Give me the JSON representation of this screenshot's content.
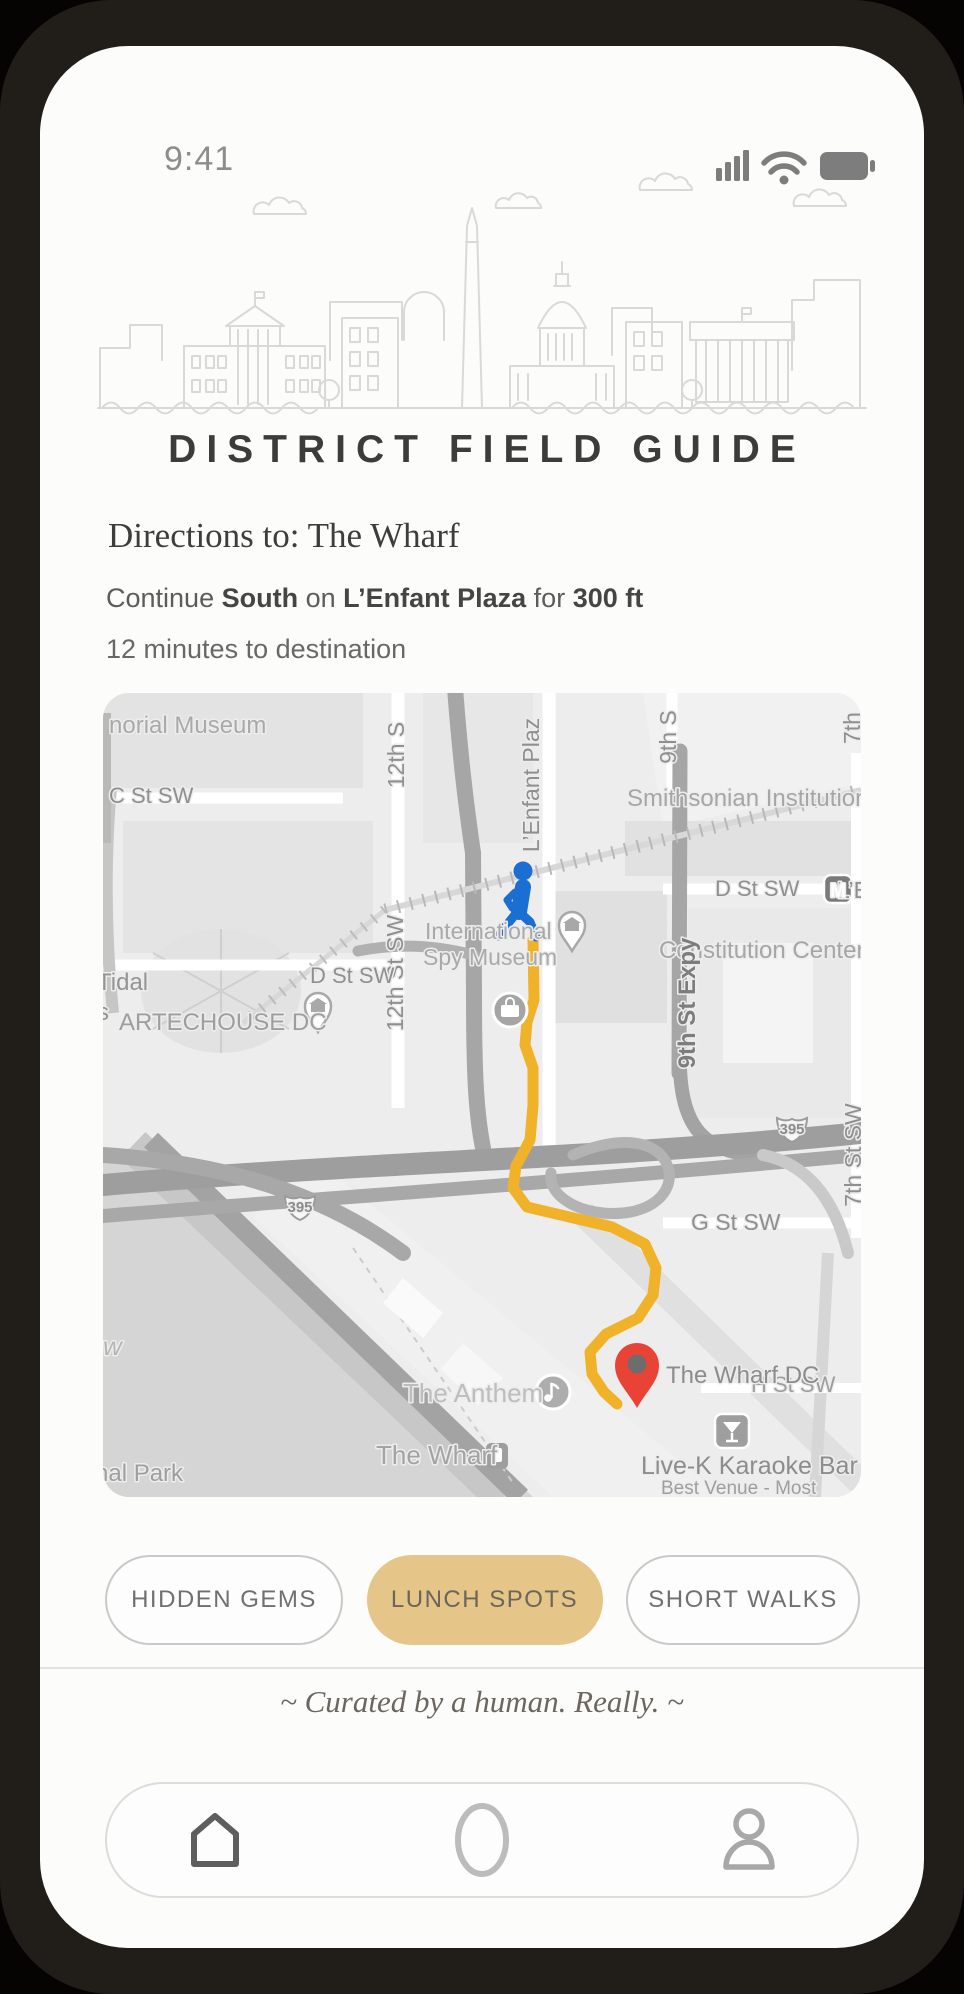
{
  "status_bar": {
    "time": "9:41",
    "icons": [
      "signal-bars",
      "wifi",
      "battery"
    ]
  },
  "header": {
    "title": "DISTRICT FIELD GUIDE",
    "skyline": "washington-dc-skyline-illustration"
  },
  "directions": {
    "heading": "Directions to: The Wharf",
    "step_segments": [
      {
        "text": "Continue ",
        "bold": false
      },
      {
        "text": "South",
        "bold": true
      },
      {
        "text": " on ",
        "bold": false
      },
      {
        "text": "L’Enfant Plaza",
        "bold": true
      },
      {
        "text": " for ",
        "bold": false
      },
      {
        "text": "300 ft",
        "bold": true
      }
    ],
    "eta": "12 minutes to destination"
  },
  "map": {
    "destination": "The Wharf DC",
    "route_color": "#F0B228",
    "walker_color": "#1C6FD2",
    "pin_color": "#E94335",
    "route_points": "430,247 431,307 424,329 422,352 430,375 430,412 427,447 413,473 410,495 424,514 462,523 509,534 542,551 553,575 550,602 535,625 503,641 487,659 489,681 501,699 514,711",
    "labels": [
      {
        "t": "norial Museum",
        "x": 6,
        "y": 40,
        "s": 24,
        "c": "#a9a9a9"
      },
      {
        "t": "C St SW",
        "x": 6,
        "y": 110,
        "s": 22,
        "c": "#8f8f8f"
      },
      {
        "t": "Tidal",
        "x": -6,
        "y": 297,
        "s": 24,
        "c": "#949494"
      },
      {
        "t": "s",
        "x": -6,
        "y": 327,
        "s": 24,
        "c": "#949494"
      },
      {
        "t": "12th S",
        "x": 301,
        "y": 62,
        "s": 23,
        "c": "#8f8f8f",
        "r": -90,
        "a": "middle"
      },
      {
        "t": "12th St SW",
        "x": 300,
        "y": 280,
        "s": 23,
        "c": "#8f8f8f",
        "r": -90,
        "a": "middle"
      },
      {
        "t": "D St SW",
        "x": 207,
        "y": 290,
        "s": 22,
        "c": "#8f8f8f"
      },
      {
        "t": "ARTECHOUSE DC",
        "x": 16,
        "y": 337,
        "s": 24,
        "c": "#9e9e9e"
      },
      {
        "t": "International",
        "x": 322,
        "y": 246,
        "s": 23,
        "c": "#a9a9a9"
      },
      {
        "t": "Spy Museum",
        "x": 320,
        "y": 272,
        "s": 23,
        "c": "#a9a9a9"
      },
      {
        "t": "L’Enfant Plaz",
        "x": 436,
        "y": 92,
        "s": 23,
        "c": "#8f8f8f",
        "r": -90,
        "a": "middle"
      },
      {
        "t": "9th S",
        "x": 573,
        "y": 44,
        "s": 23,
        "c": "#8f8f8f",
        "r": -90,
        "a": "middle"
      },
      {
        "t": "Smithsonian Institution",
        "x": 524,
        "y": 113,
        "s": 24,
        "c": "#a6a6a6"
      },
      {
        "t": "L’Enfant Pl",
        "x": 734,
        "y": 205,
        "s": 23,
        "c": "#8f8f8f"
      },
      {
        "t": "D St SW",
        "x": 612,
        "y": 203,
        "s": 22,
        "c": "#8f8f8f"
      },
      {
        "t": "M",
        "x": 735,
        "y": 204,
        "s": 19,
        "c": "#ffffff",
        "w": 700,
        "a": "middle"
      },
      {
        "t": "Constitution Center",
        "x": 556,
        "y": 265,
        "s": 24,
        "c": "#a6a6a6"
      },
      {
        "t": "9th St Expy",
        "x": 592,
        "y": 310,
        "s": 24,
        "c": "#7d7d7d",
        "r": -90,
        "a": "middle",
        "w": 600
      },
      {
        "t": "7th",
        "x": 757,
        "y": 35,
        "s": 23,
        "c": "#8f8f8f",
        "r": -90,
        "a": "middle"
      },
      {
        "t": "7th St SW",
        "x": 758,
        "y": 462,
        "s": 23,
        "c": "#8f8f8f",
        "r": -90,
        "a": "middle"
      },
      {
        "t": "395",
        "x": 197,
        "y": 519,
        "s": 15,
        "c": "#8c8c8c",
        "w": 700,
        "a": "middle"
      },
      {
        "t": "395",
        "x": 689,
        "y": 441,
        "s": 15,
        "c": "#8c8c8c",
        "w": 700,
        "a": "middle"
      },
      {
        "t": "G St SW",
        "x": 588,
        "y": 537,
        "s": 23,
        "c": "#8f8f8f"
      },
      {
        "t": "H St SW",
        "x": 648,
        "y": 699,
        "s": 22,
        "c": "#9e9e9e"
      },
      {
        "t": "The Anthem",
        "x": 300,
        "y": 709,
        "s": 26,
        "c": "#bdbdbd"
      },
      {
        "t": "The Wharf",
        "x": 273,
        "y": 771,
        "s": 26,
        "c": "#a3a3a3"
      },
      {
        "t": "The Wharf DC",
        "x": 563,
        "y": 690,
        "s": 24,
        "c": "#8c8c8c"
      },
      {
        "t": "Live-K Karaoke Bar",
        "x": 538,
        "y": 781,
        "s": 25,
        "c": "#8c8c8c"
      },
      {
        "t": "Best Venue - Most",
        "x": 558,
        "y": 801,
        "s": 19,
        "c": "#9e9e9e"
      },
      {
        "t": "nal Park",
        "x": -8,
        "y": 788,
        "s": 24,
        "c": "#9e9e9e"
      },
      {
        "t": "w",
        "x": 0,
        "y": 662,
        "s": 26,
        "c": "#b5b5b5",
        "i": true
      }
    ]
  },
  "chips": [
    {
      "label": "HIDDEN GEMS",
      "active": false
    },
    {
      "label": "LUNCH SPOTS",
      "active": true
    },
    {
      "label": "SHORT WALKS",
      "active": false
    }
  ],
  "footer": {
    "tagline": "~ Curated by a human. Really. ~"
  },
  "nav": {
    "items": [
      "home",
      "explore",
      "profile"
    ]
  },
  "colors": {
    "accent": "#E5C688",
    "route": "#F0B228",
    "walker_blue": "#1C6FD2",
    "pin_red": "#E94335"
  }
}
